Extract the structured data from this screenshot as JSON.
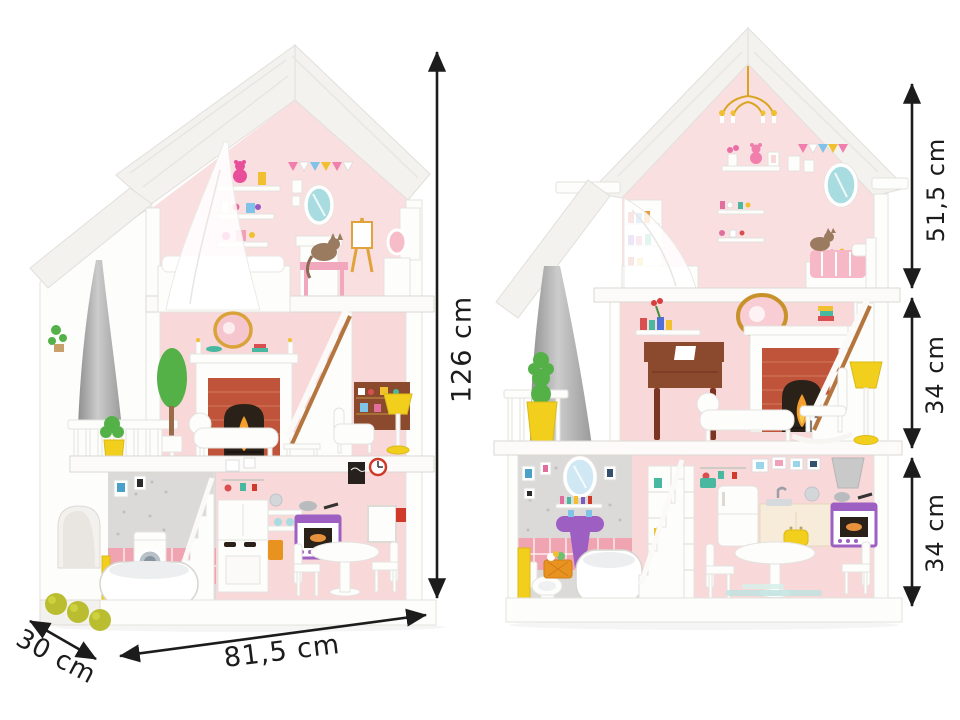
{
  "dimension_labels": {
    "overall_height": "126 cm",
    "overall_width": "81,5 cm",
    "overall_depth": "30 cm",
    "attic_floor_height": "51,5 cm",
    "middle_floor_height": "34 cm",
    "ground_floor_height": "34 cm"
  },
  "palette": {
    "background": "#ffffff",
    "arrow-black": "#1c1c1c",
    "roof-white": "#f3f2ef",
    "wall-pink": "#f8d8d9",
    "attic-pink": "#fadfe0",
    "tile-pink": "#f0a4b2",
    "tile-grey": "#dbdad8",
    "brick-red": "#c0543a",
    "flame-orange": "#f59e2c",
    "accent-yellow": "#f2cf1d",
    "accent-purple": "#9d5fc2",
    "mirror-teal": "#a8dce0",
    "wood-brown": "#8b4a2e",
    "bush-green": "#b9bd2f"
  }
}
